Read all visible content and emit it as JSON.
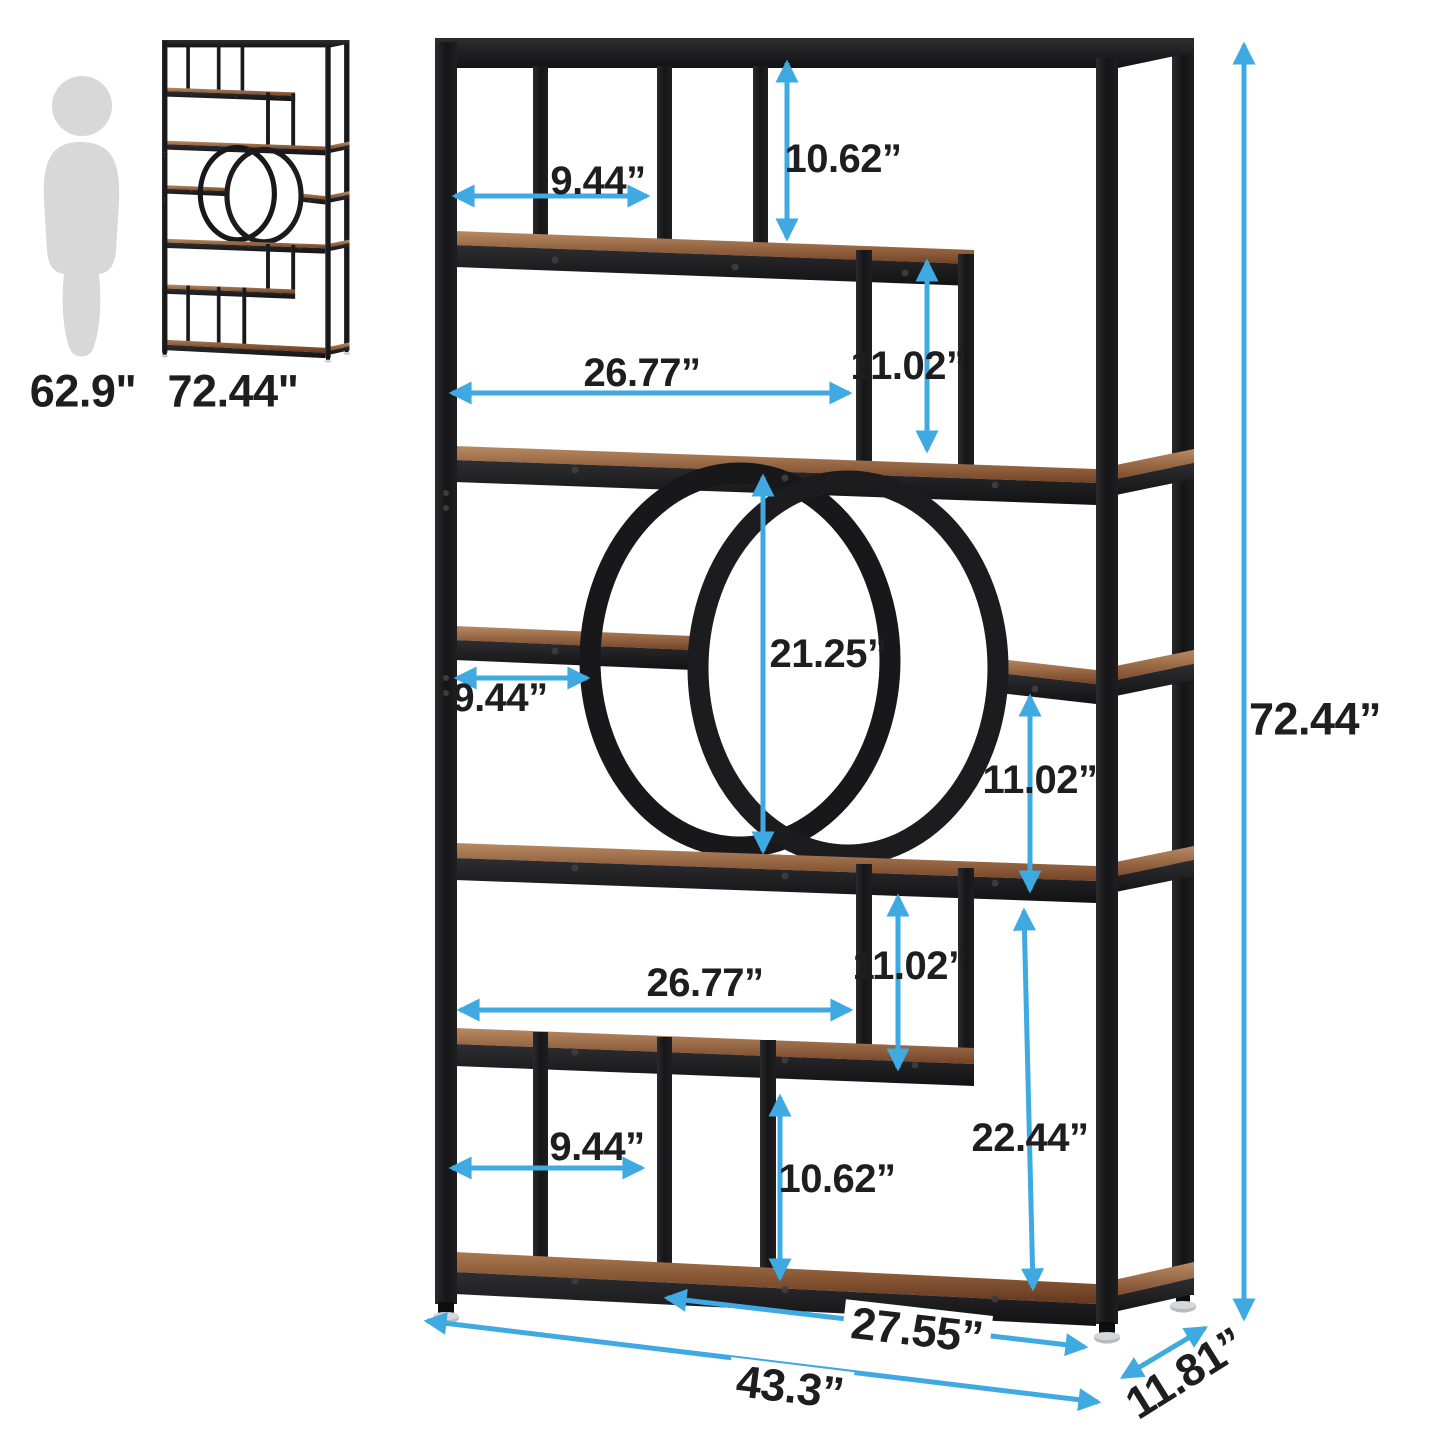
{
  "scale": {
    "person_height": "62.9\"",
    "product_height": "72.44\""
  },
  "dimensions": {
    "top_shelf_width": "9.44”",
    "top_compartment_height": "10.62”",
    "upper_long_shelf_width": "26.77”",
    "upper_step_height": "11.02”",
    "circle_opening_diameter": "21.25”",
    "middle_shelf_width": "9.44”",
    "middle_right_compartment_height": "11.02”",
    "lower_long_shelf_width": "26.77”",
    "lower_step_height": "11.02”",
    "lower_right_section_height": "22.44”",
    "bottom_shelf_width": "9.44”",
    "bottom_compartment_height": "10.62”",
    "base_front_width": "27.55”",
    "overall_width": "43.3”",
    "overall_depth": "11.81”",
    "overall_height": "72.44”"
  },
  "colors": {
    "dimension_arrow": "#3fa9e1",
    "label_text": "#1e1e20",
    "metal_frame": "#1b1b1d",
    "wood_shelf": "#7b4c2f",
    "silhouette": "#d8d8d8",
    "background": "#ffffff"
  }
}
